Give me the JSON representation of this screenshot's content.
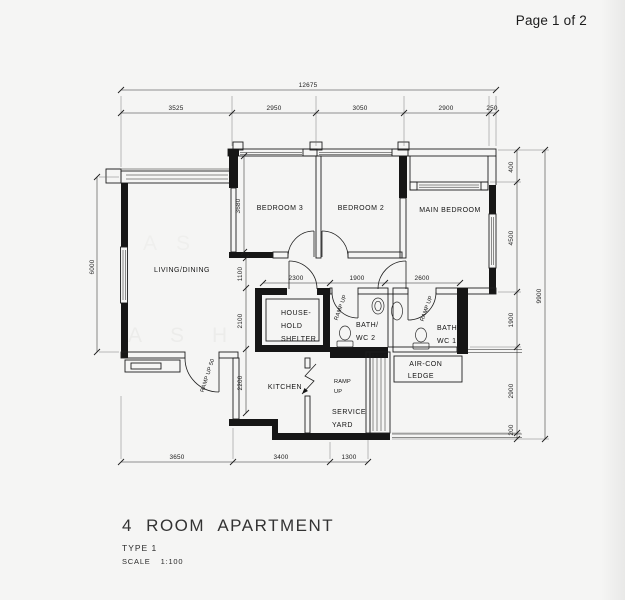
{
  "page": {
    "indicator": "Page 1 of 2"
  },
  "title_block": {
    "title": "4 ROOM APARTMENT",
    "type_label": "TYPE 1",
    "scale_label": "SCALE",
    "scale_value": "1:100"
  },
  "rooms": {
    "living_dining": "LIVING/DINING",
    "bedroom3": "BEDROOM 3",
    "bedroom2": "BEDROOM 2",
    "main_bedroom": "MAIN BEDROOM",
    "household_shelter": [
      "HOUSE-",
      "HOLD",
      "SHELTER"
    ],
    "bath_wc2": [
      "BATH/",
      "WC 2"
    ],
    "bath_wc1": [
      "BATH/",
      "WC 1"
    ],
    "aircon_ledge": [
      "AIR-CON",
      "LEDGE"
    ],
    "kitchen": "KITCHEN",
    "service_yard": [
      "SERVICE",
      "YARD"
    ]
  },
  "annotations": {
    "ramp_service": [
      "RAMP",
      "UP"
    ],
    "ramp_bath2": "RAMP UP",
    "ramp_bath1": "RAMP UP",
    "ramp_entrance": "RAMP UP 50"
  },
  "dims": {
    "top_overall": "12675",
    "top": [
      "3525",
      "2950",
      "3050",
      "2900",
      "250"
    ],
    "left": "6000",
    "right": [
      "400",
      "4500",
      "1900",
      "2900",
      "200"
    ],
    "right_overall": "9900",
    "bottom": [
      "3650",
      "3400",
      "1300"
    ],
    "mid_h": [
      "2300",
      "1900",
      "2600"
    ],
    "mid_v": [
      "1100",
      "2100",
      "2200"
    ],
    "bedroom3_depth": "3680"
  },
  "watermark": [
    "A",
    "S",
    "H",
    "L",
    "E"
  ]
}
